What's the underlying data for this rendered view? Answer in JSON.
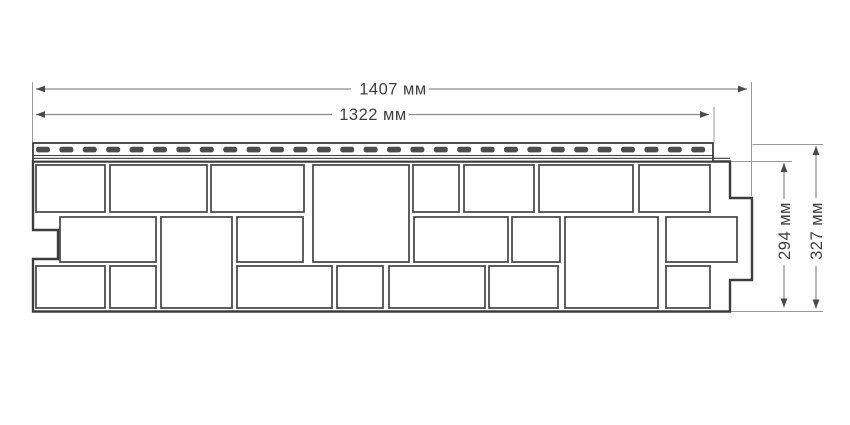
{
  "diagram": {
    "kind": "technical-dimension-drawing",
    "subject": "facade-siding-panel-front-view",
    "background": "#ffffff",
    "colors": {
      "outline": "#3c3c3c",
      "brick": "#434343",
      "dash": "#4d4d4d",
      "dim_line": "#8c8c8c",
      "ext_line": "#9a9a9a",
      "arrow": "#4a4a4a",
      "text": "#3f3f3f",
      "fill": "#ffffff"
    },
    "dimensions": {
      "total_width": {
        "label": "1407 мм",
        "value": 1407,
        "unit": "мм",
        "orientation": "h",
        "y": 89,
        "x1": 36,
        "x2": 747,
        "gap": [
          351,
          429
        ],
        "label_x": 393,
        "label_y": 94.5
      },
      "nail_strip_width": {
        "label": "1322 мм",
        "value": 1322,
        "unit": "мм",
        "orientation": "h",
        "y": 114.5,
        "x1": 36,
        "x2": 709,
        "gap": [
          332,
          409
        ],
        "label_x": 373,
        "label_y": 120
      },
      "panel_height": {
        "label": "294 мм",
        "value": 294,
        "unit": "мм",
        "orientation": "v",
        "x": 784,
        "y1": 163,
        "y2": 307.5,
        "gap": [
          199,
          265
        ],
        "label_x": 790,
        "label_y": 231
      },
      "total_height": {
        "label": "327 мм",
        "value": 327,
        "unit": "мм",
        "orientation": "v",
        "x": 816,
        "y1": 146,
        "y2": 308.5,
        "gap": [
          198,
          266
        ],
        "label_x": 822,
        "label_y": 231
      }
    },
    "extension_lines": [
      [
        32.5,
        82,
        32.5,
        142
      ],
      [
        751.5,
        82,
        751.5,
        196
      ],
      [
        714,
        107,
        714,
        142
      ],
      [
        731,
        161.5,
        792,
        161.5
      ],
      [
        752.5,
        144.5,
        823,
        144.5
      ],
      [
        731,
        311.5,
        823,
        311.5
      ]
    ],
    "panel": {
      "outline": [
        [
          33,
          161.5
        ],
        [
          730,
          161.5
        ],
        [
          730,
          198
        ],
        [
          752,
          198
        ],
        [
          752,
          280
        ],
        [
          730,
          280
        ],
        [
          730,
          311.5
        ],
        [
          33,
          311.5
        ],
        [
          33,
          259
        ],
        [
          58,
          259
        ],
        [
          58,
          230
        ],
        [
          33,
          230
        ]
      ],
      "nail_strip": {
        "x": 33,
        "y": 143,
        "w": 680,
        "h": 18.5,
        "inner_lines": [
          [
            33,
            155.5,
            713,
            155.5
          ],
          [
            33,
            158.3,
            730,
            158.3
          ]
        ],
        "dash": {
          "x0": 36,
          "x_end": 709,
          "y": 146.8,
          "w": 14,
          "h": 5.6,
          "pitch": 23.4,
          "rx": 2.4
        }
      },
      "bricks": [
        [
          36,
          165,
          69,
          47
        ],
        [
          110,
          165,
          97,
          47
        ],
        [
          211,
          165,
          93,
          47
        ],
        [
          313,
          165,
          96,
          97
        ],
        [
          413,
          165,
          46,
          47
        ],
        [
          464,
          165,
          70,
          47
        ],
        [
          539,
          165,
          94,
          47
        ],
        [
          639,
          165,
          71,
          47
        ],
        [
          60,
          217,
          96,
          45
        ],
        [
          161,
          217,
          71,
          91
        ],
        [
          237,
          217,
          66,
          45
        ],
        [
          414,
          217,
          94,
          45
        ],
        [
          512,
          217,
          48,
          45
        ],
        [
          565,
          217,
          93,
          91
        ],
        [
          666,
          217,
          71,
          45
        ],
        [
          36,
          266,
          69,
          42
        ],
        [
          110,
          266,
          46,
          42
        ],
        [
          237,
          266,
          95,
          42
        ],
        [
          337,
          266,
          46,
          42
        ],
        [
          389,
          266,
          96,
          42
        ],
        [
          489,
          266,
          69,
          42
        ],
        [
          666,
          266,
          44,
          42
        ]
      ]
    }
  }
}
